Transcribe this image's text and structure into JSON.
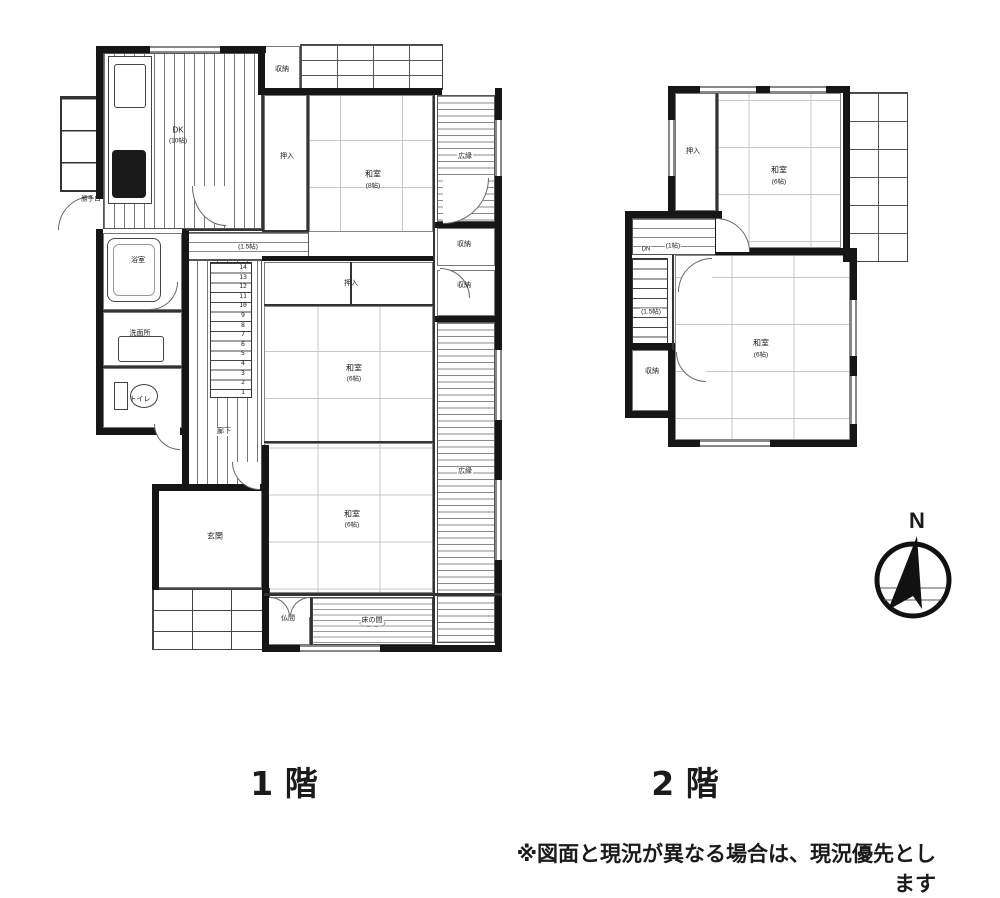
{
  "floor1": {
    "caption": "1 階",
    "labels": {
      "dk_name": "DK",
      "dk_size": "(10帖)",
      "kattegu": "勝手口",
      "bath": "浴室",
      "washroom": "洗面所",
      "toilet": "トイレ",
      "corridor": "廊下",
      "hall_size": "(1.5帖)",
      "stair_numbers": "14\n13\n12\n11\n10\n9\n8\n7\n6\n5\n4\n3\n2\n1",
      "oshiire_n": "押入",
      "washitsu_n_name": "和室",
      "washitsu_n_size": "(8帖)",
      "hiroen_n": "広縁",
      "shuno_top": "収納",
      "shuno_r1": "収納",
      "shuno_r2": "収納",
      "oshiire_c": "押入",
      "washitsu_c_name": "和室",
      "washitsu_c_size": "(6帖)",
      "hiroen_s": "広縁",
      "washitsu_s_name": "和室",
      "washitsu_s_size": "(6帖)",
      "genkan": "玄関",
      "butsuma": "仏間",
      "tokonoma": "床の間"
    }
  },
  "floor2": {
    "caption": "2 階",
    "labels": {
      "oshiire": "押入",
      "washitsu_n_name": "和室",
      "washitsu_n_size": "(6帖)",
      "hall_size": "(1帖)",
      "dn": "DN",
      "stairs_size": "(1.5帖)",
      "shuno": "収納",
      "washitsu_s_name": "和室",
      "washitsu_s_size": "(6帖)"
    }
  },
  "compass": {
    "north": "N"
  },
  "footer": {
    "note": "※図面と現況が異なる場合は、現況優先とします"
  },
  "colors": {
    "wall": "#161616",
    "line": "#666666",
    "text": "#1b1b1b"
  }
}
